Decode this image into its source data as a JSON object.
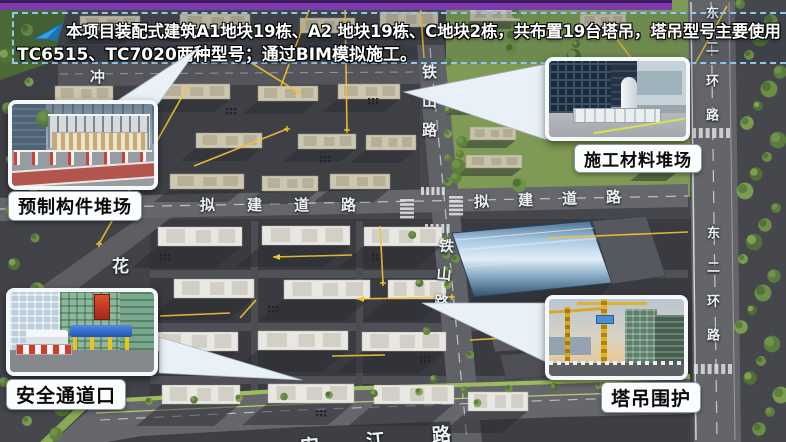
{
  "banner": {
    "line1": "本项目装配式建筑A1地块19栋、A2 地块19栋、C地块2栋，共布置19台塔吊，塔吊型号主要使用",
    "line2": "TC6515、TC7020两种型号；通过BIM模拟施工。",
    "arrow_icon": "blue-cursor-arrow",
    "border_color": "#8EC7F0"
  },
  "header_bar": {
    "color": "#7B3BAC"
  },
  "callouts": {
    "precast": {
      "label": "预制构件堆场"
    },
    "materials": {
      "label": "施工材料堆场"
    },
    "safety": {
      "label": "安全通道口"
    },
    "crane": {
      "label": "塔吊围护"
    }
  },
  "road_labels": {
    "tieshan_north": "铁山路",
    "tieshan_south": "铁山路",
    "proposed_road_west": "拟建道路",
    "proposed_road_east": "拟建道路",
    "east_second_ring_north": "东二环路",
    "east_second_ring_south": "东二环路",
    "hua": "花",
    "chong": "冲",
    "anjiang": "安江路"
  },
  "scene_colors": {
    "crane_line_yellow": "#F3C431",
    "factory_roof_blue": "#A8C8E2",
    "site_ground": "#3A3B40",
    "park_green": "#7E9A55"
  }
}
